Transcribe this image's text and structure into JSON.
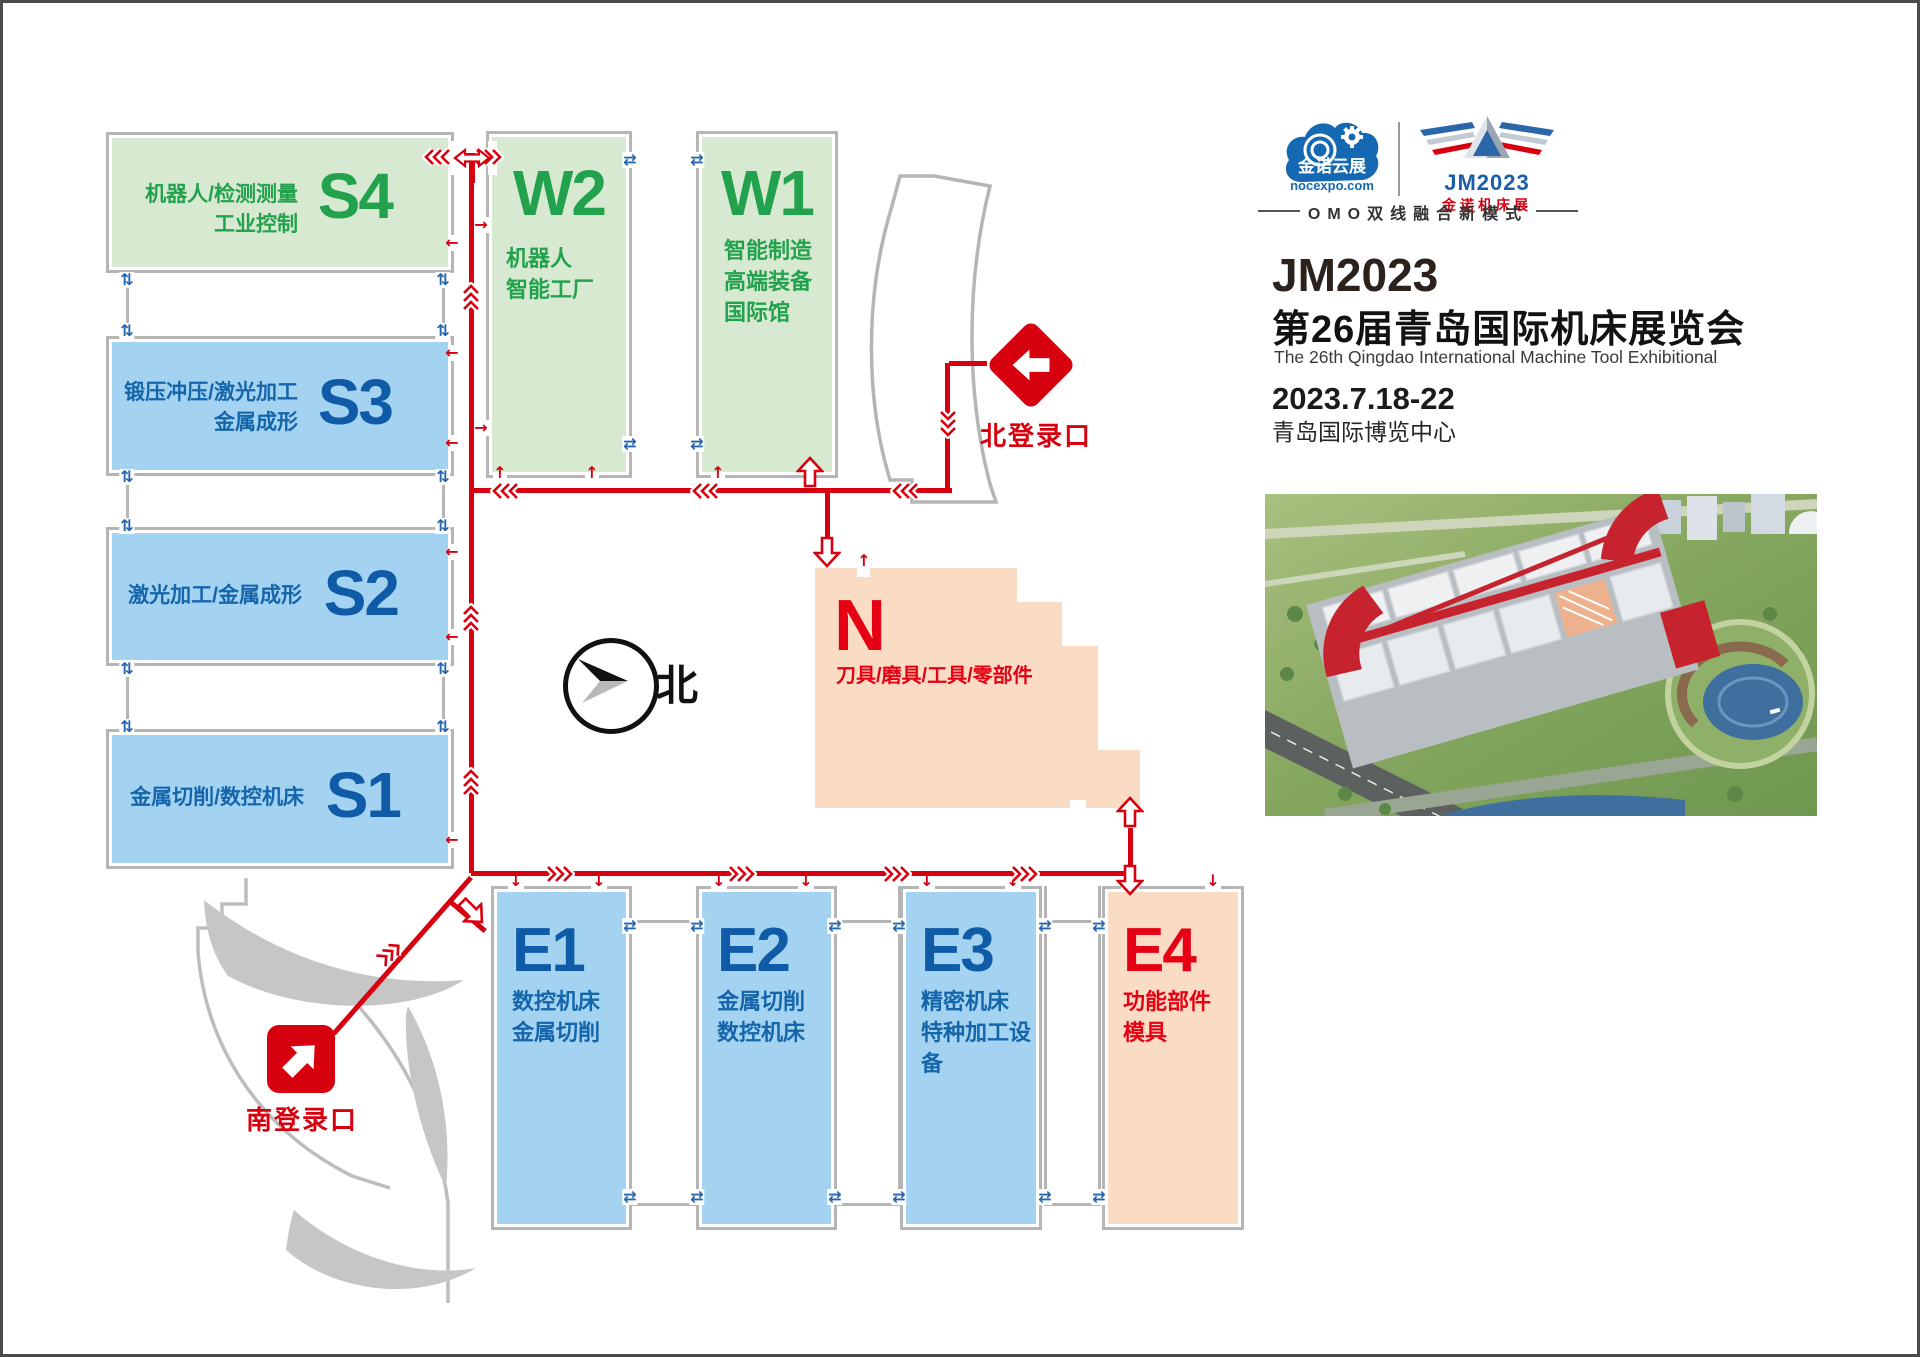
{
  "page_title": "JM2023 第26届青岛国际机床展览会 展馆分布图",
  "colors": {
    "route_red": "#d7000f",
    "hall_green": "#d8e9d2",
    "hall_blue": "#a3d3f1",
    "hall_peach": "#fadcc4",
    "text_green": "#22a24d",
    "text_blue": "#0f5ba8",
    "text_red": "#e60013",
    "wall_gray": "#b5b5b5",
    "logo_blue": "#1569b3"
  },
  "icons": {
    "transfer_h": "⇄",
    "transfer_v": "⇅",
    "door_down": "↓",
    "door_up": "↑",
    "door_left": "←",
    "door_right": "→"
  },
  "map": {
    "compass_label": "北",
    "entrances": {
      "north": {
        "label": "北登录口"
      },
      "south": {
        "label": "南登录口"
      }
    },
    "halls": {
      "s4": {
        "id": "S4",
        "lines": [
          "机器人/检测测量",
          "工业控制"
        ]
      },
      "s3": {
        "id": "S3",
        "lines": [
          "锻压冲压/激光加工",
          "金属成形"
        ]
      },
      "s2": {
        "id": "S2",
        "lines": [
          "激光加工/金属成形"
        ]
      },
      "s1": {
        "id": "S1",
        "lines": [
          "金属切削/数控机床"
        ]
      },
      "w2": {
        "id": "W2",
        "lines": [
          "机器人",
          "智能工厂"
        ]
      },
      "w1": {
        "id": "W1",
        "lines": [
          "智能制造",
          "高端装备",
          "国际馆"
        ]
      },
      "n": {
        "id": "N",
        "lines": [
          "刀具/磨具/工具/零部件"
        ]
      },
      "e1": {
        "id": "E1",
        "lines": [
          "数控机床",
          "金属切削"
        ]
      },
      "e2": {
        "id": "E2",
        "lines": [
          "金属切削",
          "数控机床"
        ]
      },
      "e3": {
        "id": "E3",
        "lines": [
          "精密机床",
          "特种加工设备"
        ]
      },
      "e4": {
        "id": "E4",
        "lines": [
          "功能部件",
          "模具"
        ]
      }
    }
  },
  "panel": {
    "cloud_logo": {
      "name": "金诺云展",
      "domain": "nocexpo.com"
    },
    "jm_logo": {
      "line1": "JM2023",
      "line2": "金诺机床展"
    },
    "slogan": "OMO双线融合新模式",
    "logo_wordmark": "JM2023",
    "title_cn": "第26届青岛国际机床展览会",
    "title_en": "The 26th Qingdao International Machine Tool Exhibitional",
    "dates": "2023.7.18-22",
    "venue": "青岛国际博览中心"
  }
}
